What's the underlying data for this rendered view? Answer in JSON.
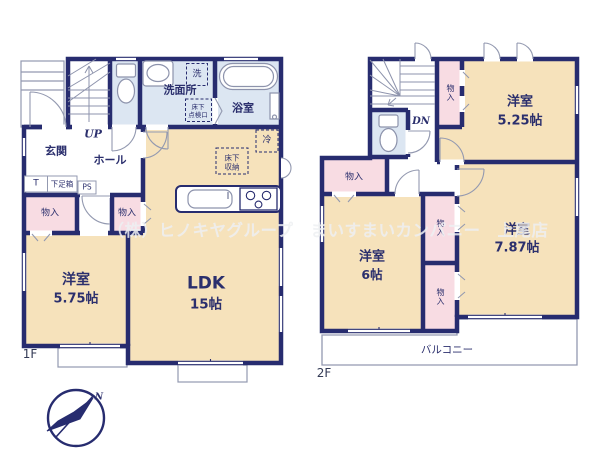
{
  "watermark": "（株）ヒノキヤグループ　まいすまいカンパニー　上尾店",
  "compass": {
    "north": "N"
  },
  "floor1": {
    "label": "1F",
    "rooms": {
      "entrance": "玄関",
      "hall": "ホール",
      "washroom": "洗面所",
      "bathroom": "浴室",
      "western_room": "洋室",
      "western_room_size": "5.75帖",
      "ldk": "LDK",
      "ldk_size": "15帖",
      "storage_left": "物入",
      "storage_mid": "物入"
    },
    "annotations": {
      "up": "UP",
      "ps": "PS",
      "t": "T",
      "shoe_box": "下足箱",
      "washer": "洗",
      "fridge": "冷",
      "underfloor_access_1": "床下",
      "underfloor_access_2": "点検口",
      "underfloor_storage_1": "床下",
      "underfloor_storage_2": "収納"
    }
  },
  "floor2": {
    "label": "2F",
    "rooms": {
      "western_room_1": "洋室",
      "western_room_1_size": "5.25帖",
      "western_room_2": "洋室",
      "western_room_2_size": "7.87帖",
      "western_room_3": "洋室",
      "western_room_3_size": "6帖",
      "storage_top": "物入",
      "storage_left": "物入",
      "storage_mid_upper": "物入",
      "storage_mid_lower": "物入",
      "balcony": "バルコニー"
    },
    "annotations": {
      "dn": "DN"
    }
  },
  "colors": {
    "wall": "#272c6f",
    "room_cream": "#f6e2bb",
    "room_blue": "#dce6f2",
    "room_pink": "#f8dce3",
    "thin_line": "#9399b0"
  }
}
